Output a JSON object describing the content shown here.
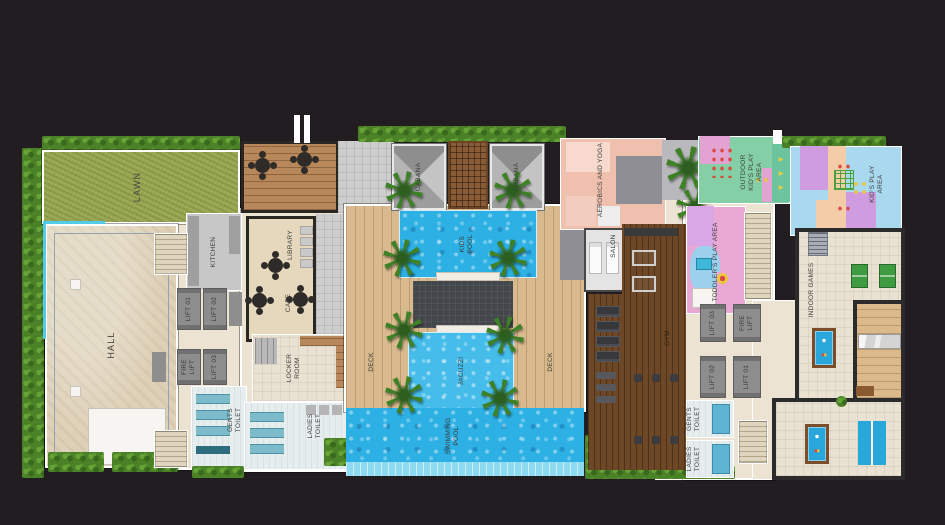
{
  "meta": {
    "type": "architectural-floor-plan",
    "description": "Clubhouse amenity level floor plan with pools, gym and play areas on dark background"
  },
  "colors": {
    "background": "#211d21",
    "wall": "#ffffff",
    "dark_wall": "#2b2b2b",
    "water": "#2db0e4",
    "pool_edge": "#8edaf2",
    "lawn": "#98a751",
    "hedge": "#4c8227",
    "deck_wood": "#d8ba8e",
    "cafe_wood": "#b8875a",
    "gym_wood": "#6e4826",
    "hall_floor": "#ded1b8",
    "tile_salmon": "#eec0ad",
    "play_pink": "#e9a8d4",
    "play_teal": "#85cfa6",
    "play_blue": "#a9d9ef",
    "lift_gray": "#8d8d8d",
    "toilet_teal": "#7cbcca"
  },
  "icons": {
    "arrow_right": "▶"
  },
  "rooms": {
    "lawn": {
      "label": "LAWN"
    },
    "hall": {
      "label": "HALL"
    },
    "kitchen": {
      "label": "KITCHEN"
    },
    "lift01_left": {
      "label": "LIFT 01"
    },
    "lift02_left": {
      "label": "LIFT 02"
    },
    "fire_lift_left": {
      "label": "FIRE LIFT"
    },
    "lift03_left": {
      "label": "LIFT 03"
    },
    "gents_toilet_left": {
      "label": "GENTS TOILET"
    },
    "library": {
      "label": "LIBRARY"
    },
    "cafe": {
      "label": "CAFE"
    },
    "locker_room": {
      "label": "LOCKER ROOM"
    },
    "ladies_toilet_left": {
      "label": "LADIES TOILET"
    },
    "cabana_left": {
      "label": "CABANA"
    },
    "cabana_right": {
      "label": "CABANA"
    },
    "kids_pool": {
      "label": "KIDS POOL"
    },
    "jacuzzi": {
      "label": "JACUZZI"
    },
    "deck_left": {
      "label": "DECK"
    },
    "deck_right": {
      "label": "DECK"
    },
    "swimming_pool": {
      "label": "SWIMMING POOL"
    },
    "aerobics_yoga": {
      "label": "AEROBICS AND YOGA"
    },
    "salon": {
      "label": "SALON"
    },
    "gym": {
      "label": "GYM"
    },
    "toddlers_play": {
      "label": "TODDLER'S PLAY AREA"
    },
    "outdoor_kids_play": {
      "label": "OUTDOOR KID'S PLAY AREA"
    },
    "kids_play": {
      "label": "KID'S PLAY AREA"
    },
    "indoor_games": {
      "label": "INDOOR GAMES"
    },
    "lift03_right": {
      "label": "LIFT 03"
    },
    "fire_lift_right": {
      "label": "FIRE LIFT"
    },
    "lift02_right": {
      "label": "LIFT 02"
    },
    "lift01_right": {
      "label": "LIFT 01"
    },
    "gents_toilet_right": {
      "label": "GENTS TOILET"
    },
    "ladies_toilet_right": {
      "label": "LADIES TOILET"
    }
  }
}
